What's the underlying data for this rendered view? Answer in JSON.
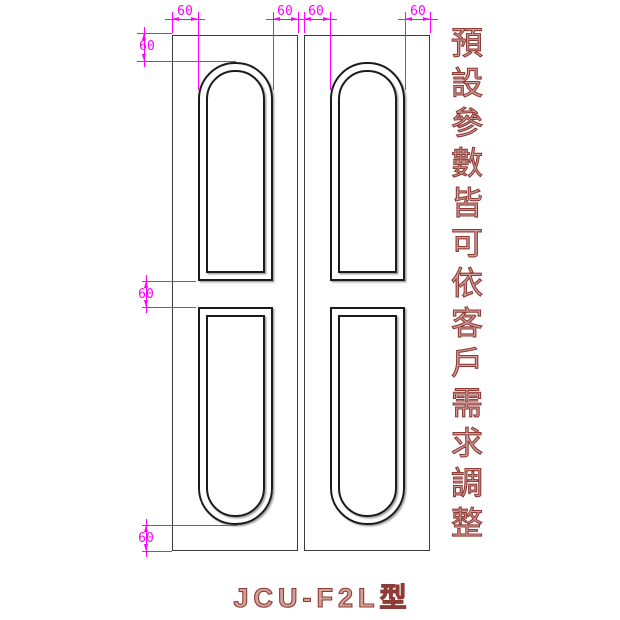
{
  "title": "JCU-F2L型",
  "side_note": "預設參數皆可依客戶需求調整",
  "dimensions": {
    "top": [
      {
        "label": "60"
      },
      {
        "label": "60"
      },
      {
        "label": "60"
      },
      {
        "label": "60"
      }
    ],
    "left": [
      {
        "label": "60"
      },
      {
        "label": "60"
      },
      {
        "label": "60"
      }
    ]
  },
  "colors": {
    "dimension": "#ff00ff",
    "drawing_line": "#1b1b1b",
    "annotation": "#8e3b36",
    "background": "#ffffff"
  }
}
